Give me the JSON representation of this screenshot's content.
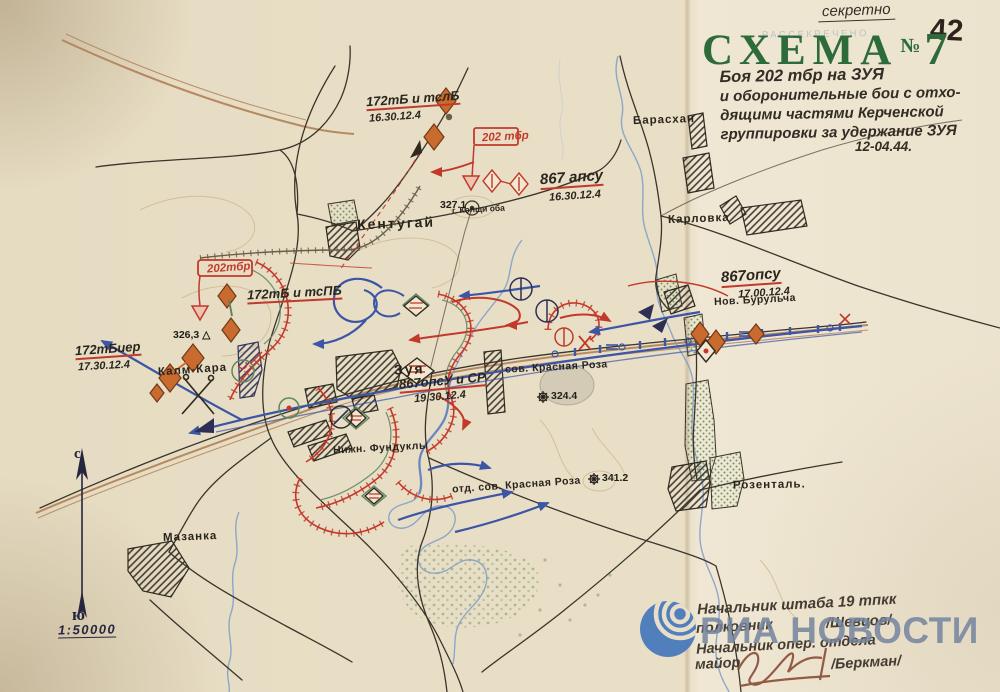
{
  "header": {
    "secrecy": "секретно",
    "page_number": "42",
    "declassified_stamp": "РАССЕКРЕЧЕНО",
    "title_word": "СХЕМА",
    "title_number_sign": "№",
    "title_number": "7",
    "subtitle_lines": [
      "Боя 202 тбр на ЗУЯ",
      "и оборонительные бои с отхо-",
      "дящими частями Керченской",
      "группировки за удержание ЗУЯ"
    ],
    "date": "12-04.44."
  },
  "map": {
    "scale": "1:50000",
    "compass": {
      "north": "с",
      "south": "ю"
    },
    "labels": [
      {
        "n": "label-unit-172tb-tslb",
        "t": "172тБ и тслБ",
        "x": 366,
        "y": 92,
        "c": "u ul",
        "rot": -4
      },
      {
        "n": "label-unit-172tb-tslb-time",
        "t": "16.30.12.4",
        "x": 369,
        "y": 112,
        "c": "u d",
        "rot": -4
      },
      {
        "n": "label-unit-202tbr-flag",
        "t": "202 тбр",
        "x": 482,
        "y": 132,
        "c": "u red sm",
        "rot": -3
      },
      {
        "n": "label-unit-867apsu",
        "t": "867 апсу",
        "x": 540,
        "y": 170,
        "c": "u lg ul",
        "rot": -4
      },
      {
        "n": "label-unit-867apsu-time",
        "t": "16.30.12.4",
        "x": 549,
        "y": 191,
        "c": "u d",
        "rot": -4
      },
      {
        "n": "label-unit-202tbr-box",
        "t": "202тбр",
        "x": 207,
        "y": 263,
        "c": "u red sm",
        "rot": -4
      },
      {
        "n": "label-unit-172tb-tspb",
        "t": "172тБ и тсПБ",
        "x": 247,
        "y": 286,
        "c": "u ul",
        "rot": -3
      },
      {
        "n": "label-unit-172tbier",
        "t": "172тБиер",
        "x": 75,
        "y": 342,
        "c": "u ul",
        "rot": -4
      },
      {
        "n": "label-unit-172tbier-time",
        "t": "17.30.12.4",
        "x": 78,
        "y": 361,
        "c": "u d",
        "rot": -3
      },
      {
        "n": "label-unit-867opsu-east",
        "t": "867опсу",
        "x": 721,
        "y": 268,
        "c": "u lg ul",
        "rot": -4
      },
      {
        "n": "label-unit-867opsu-east-time",
        "t": "17.00.12.4",
        "x": 738,
        "y": 288,
        "c": "u d",
        "rot": -4
      },
      {
        "n": "label-unit-867opsu-sr",
        "t": "867опсУ и СР",
        "x": 399,
        "y": 374,
        "c": "u ul",
        "rot": -5
      },
      {
        "n": "label-unit-867opsu-sr-time",
        "t": "19.30.12.4",
        "x": 414,
        "y": 392,
        "c": "u d",
        "rot": -5
      },
      {
        "n": "label-village-kentugay",
        "t": "Кентугай",
        "x": 357,
        "y": 216,
        "c": "v lg",
        "rot": -2
      },
      {
        "n": "label-village-baraskhan",
        "t": "Барасхан",
        "x": 633,
        "y": 115,
        "c": "v",
        "rot": -2
      },
      {
        "n": "label-village-karlovka",
        "t": "Карловка",
        "x": 668,
        "y": 214,
        "c": "v",
        "rot": -2
      },
      {
        "n": "label-village-kalm-kara",
        "t": "Калм-Кара",
        "x": 158,
        "y": 365,
        "c": "v",
        "rot": -4
      },
      {
        "n": "label-village-nizhn-fundukly",
        "t": "Нижн. Фундуклы",
        "x": 333,
        "y": 443,
        "c": "v sm",
        "rot": -3
      },
      {
        "n": "label-village-mazanka",
        "t": "Мазанка",
        "x": 163,
        "y": 532,
        "c": "v",
        "rot": -2
      },
      {
        "n": "label-village-rosental",
        "t": "Розенталь.",
        "x": 733,
        "y": 480,
        "c": "v",
        "rot": -1
      },
      {
        "n": "label-village-nov-burulcha",
        "t": "Нов. Бурульча",
        "x": 714,
        "y": 295,
        "c": "v sm",
        "rot": -3
      },
      {
        "n": "label-town-zuya",
        "t": "Зуя",
        "x": 394,
        "y": 362,
        "c": "v lg",
        "rot": -3
      },
      {
        "n": "label-sovkhoz-krasnaya-roza",
        "t": "сов. Красная Роза",
        "x": 505,
        "y": 362,
        "c": "v sm",
        "rot": -3
      },
      {
        "n": "label-otd-sovkhoz-krasnaya-roza",
        "t": "отд. сов. Красная Роза",
        "x": 452,
        "y": 480,
        "c": "v sm",
        "rot": -4
      },
      {
        "n": "label-hill-kolshchi-oba",
        "t": "г. Колщи оба",
        "x": 452,
        "y": 205,
        "c": "v xs",
        "rot": -3
      },
      {
        "n": "label-height-327-1",
        "t": "327.1",
        "x": 440,
        "y": 200,
        "c": "h"
      },
      {
        "n": "label-height-326-3",
        "t": "326,3 △",
        "x": 173,
        "y": 330,
        "c": "h"
      },
      {
        "n": "label-height-324-4",
        "t": "324.4",
        "x": 551,
        "y": 391,
        "c": "h"
      },
      {
        "n": "label-height-341-2",
        "t": "341.2",
        "x": 602,
        "y": 473,
        "c": "h"
      }
    ]
  },
  "signature": {
    "lines": [
      "Начальник штаба 19 тпкк",
      "полковник",
      "/Шевцов/",
      "Начальник опер. отдела",
      "майор",
      "/Беркман/"
    ]
  },
  "watermark": {
    "text": "РИА НОВОСТИ"
  },
  "colors": {
    "paper": "#e8dfc7",
    "ink": "#2e2a20",
    "red": "#c23b2a",
    "blue": "#3c55a5",
    "title_green": "#2d6b3a",
    "watermark_blue": "#74849e",
    "orange": "#c96a2e"
  }
}
